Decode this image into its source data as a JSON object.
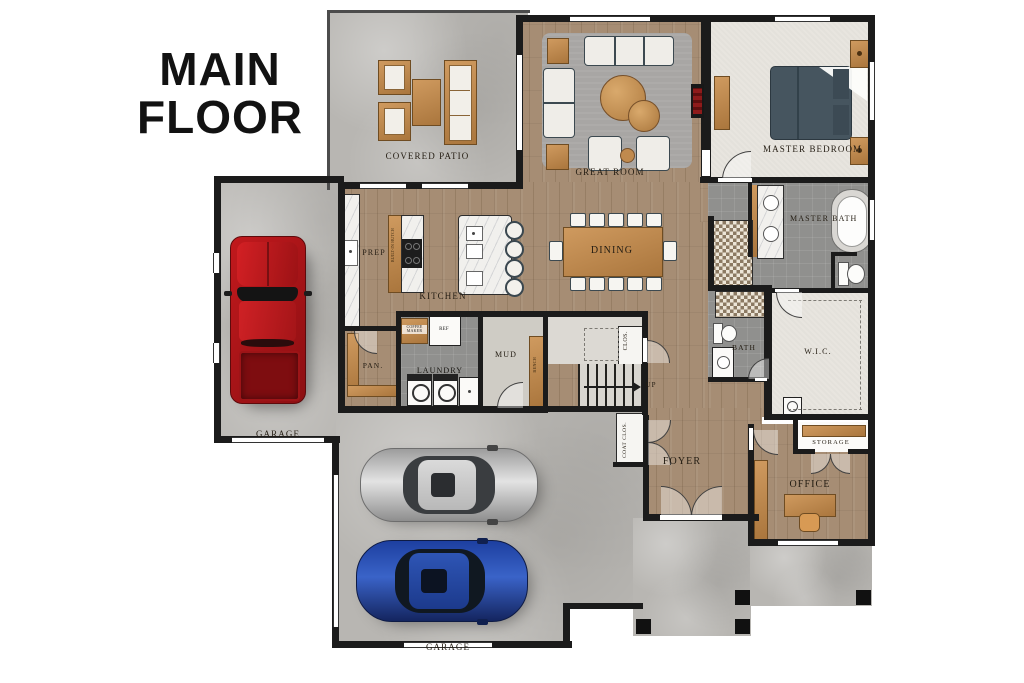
{
  "title": "MAIN FLOOR",
  "rooms": {
    "covered_patio": {
      "label": "COVERED PATIO"
    },
    "great_room": {
      "label": "GREAT ROOM"
    },
    "master_bedroom": {
      "label": "MASTER BEDROOM"
    },
    "master_bath": {
      "label": "MASTER BATH"
    },
    "bath": {
      "label": "BATH"
    },
    "wic": {
      "label": "W.I.C."
    },
    "kitchen": {
      "label": "KITCHEN"
    },
    "prep": {
      "label": "PREP"
    },
    "dining": {
      "label": "DINING"
    },
    "pantry": {
      "label": "PAN."
    },
    "laundry": {
      "label": "LAUNDRY"
    },
    "mud": {
      "label": "MUD"
    },
    "closet": {
      "label": "CLOS."
    },
    "coat_closet": {
      "label": "COAT CLOS."
    },
    "foyer": {
      "label": "FOYER"
    },
    "office": {
      "label": "OFFICE"
    },
    "storage": {
      "label": "STORAGE"
    },
    "garage_left": {
      "label": "GARAGE"
    },
    "garage_bottom": {
      "label": "GARAGE"
    }
  },
  "annotations": {
    "up": "UP",
    "ref": "REF",
    "coffee_maker": "COFFEE MAKER",
    "bench": "BENCH",
    "built_in": "BUILT-IN HUTCH"
  },
  "colors": {
    "wall": "#1b1b1b",
    "wood_floor": "#a68d74",
    "concrete": "#b8b6b2",
    "carpet": "#e8e5df",
    "bath_tile": "#90908e",
    "furniture_tan": "#c89057",
    "truck_red": "#b01116",
    "car_silver": "#c9c9c9",
    "car_blue": "#2a4fb0",
    "fireplace_red": "#8e1b1b"
  }
}
